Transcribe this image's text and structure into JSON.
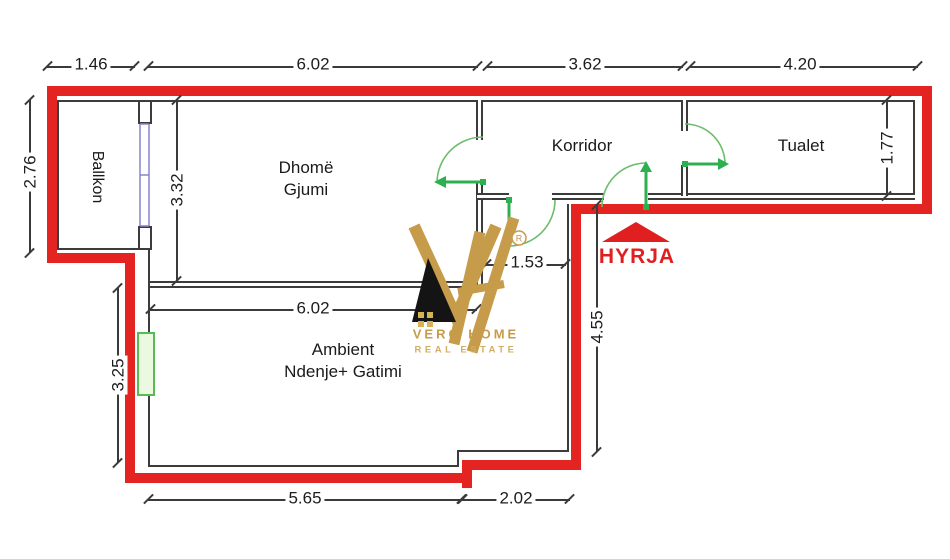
{
  "plan_type": "apartment-floor-plan",
  "rooms": {
    "balcony": "Ballkon",
    "bedroom_l1": "Dhomë",
    "bedroom_l2": "Gjumi",
    "corridor": "Korridor",
    "toilet": "Tualet",
    "living_l1": "Ambient",
    "living_l2": "Ndenje+ Gatimi"
  },
  "entrance": {
    "label": "HYRJA"
  },
  "dims": {
    "top_1": "1.46",
    "top_2": "6.02",
    "top_3": "3.62",
    "top_4": "4.20",
    "balcony_h": "2.76",
    "bedroom_h": "3.32",
    "living_h": "3.25",
    "toilet_h": "1.77",
    "hall_w": "1.53",
    "living_w": "6.02",
    "entry_wall": "4.55",
    "bottom_1": "5.65",
    "bottom_2": "2.02"
  },
  "logo": {
    "brand": "VERO HOME",
    "tagline": "REAL ESTATE",
    "registered": "R"
  },
  "colors": {
    "wall_red": "#e42420",
    "door_green": "#2eb050",
    "interior_wall": "#3c3c3c",
    "logo_gold": "#c69c4a",
    "entrance_red": "#e02020",
    "window_green": "#55bb55",
    "window_blue": "#8585cc"
  }
}
